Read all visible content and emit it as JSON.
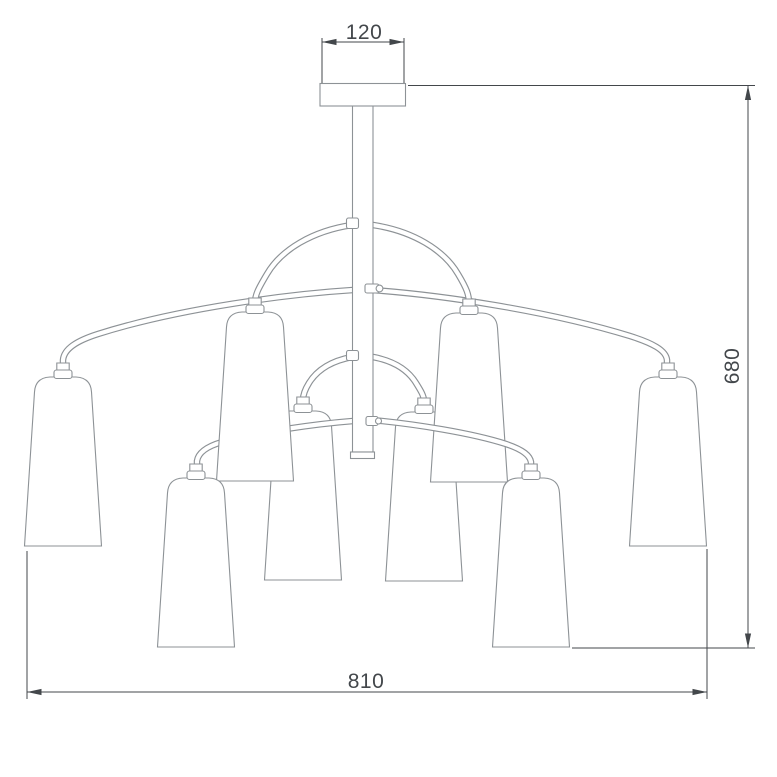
{
  "diagram": {
    "kind": "chandelier-dimension-drawing",
    "dimensions": {
      "canopy_width_mm": "120",
      "overall_height_mm": "680",
      "overall_diameter_mm": "810"
    },
    "colors": {
      "background": "#ffffff",
      "outline": "#8d9296",
      "dimension": "#43474b"
    }
  }
}
